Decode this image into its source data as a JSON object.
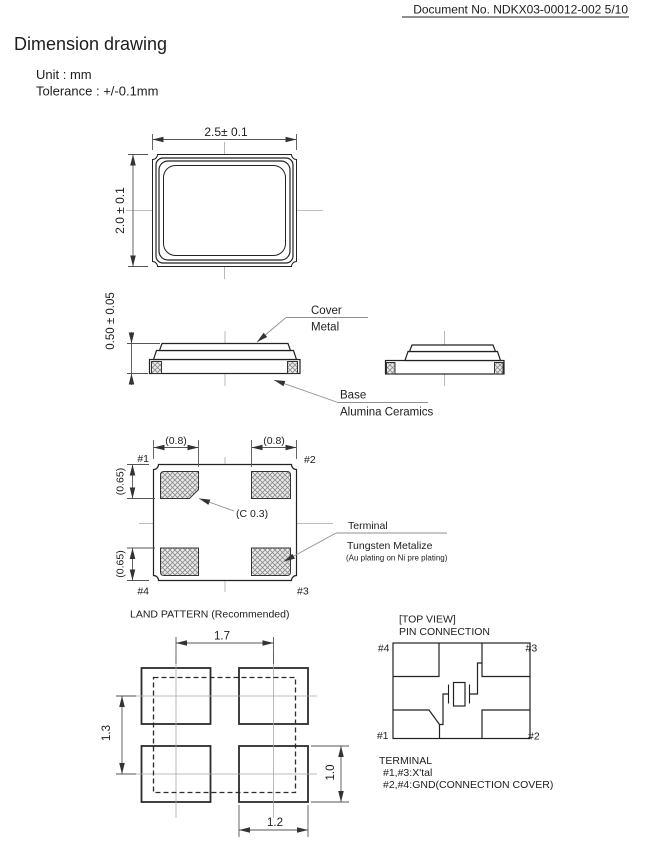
{
  "header": {
    "doc_no": "Document No. NDKX03-00012-002 5/10"
  },
  "title": "Dimension drawing",
  "notes": {
    "unit": "Unit : mm",
    "tolerance": "Tolerance : +/-0.1mm"
  },
  "top_view": {
    "width_dim": "2.5± 0.1",
    "height_dim": "2.0 ± 0.1"
  },
  "side_view": {
    "thickness_dim": "0.50 ± 0.05",
    "cover_label": "Cover",
    "cover_material": "Metal",
    "base_label": "Base",
    "base_material": "Alumina Ceramics"
  },
  "terminal_view": {
    "pad_width_dim_left": "(0.8)",
    "pad_width_dim_right": "(0.8)",
    "pad_height_dim_top": "(0.65)",
    "pad_height_dim_bottom": "(0.65)",
    "chamfer_dim": "(C 0.3)",
    "pin1": "#1",
    "pin2": "#2",
    "pin3": "#3",
    "pin4": "#4",
    "terminal_label": "Terminal",
    "terminal_material": "Tungsten Metalize",
    "terminal_note": "(Au plating on Ni pre plating)"
  },
  "land_pattern": {
    "caption": "LAND PATTERN  (Recommended)",
    "pitch_x_dim": "1.7",
    "pitch_y_dim": "1.3",
    "pad_height_dim": "1.0",
    "pad_width_dim": "1.2"
  },
  "pin_connection": {
    "heading_line1": "[TOP VIEW]",
    "heading_line2": "PIN CONNECTION",
    "pin1": "#1",
    "pin2": "#2",
    "pin3": "#3",
    "pin4": "#4",
    "terminal_title": "TERMINAL",
    "terminal_line1": "#1,#3:X'tal",
    "terminal_line2": "#2,#4:GND(CONNECTION COVER)"
  }
}
